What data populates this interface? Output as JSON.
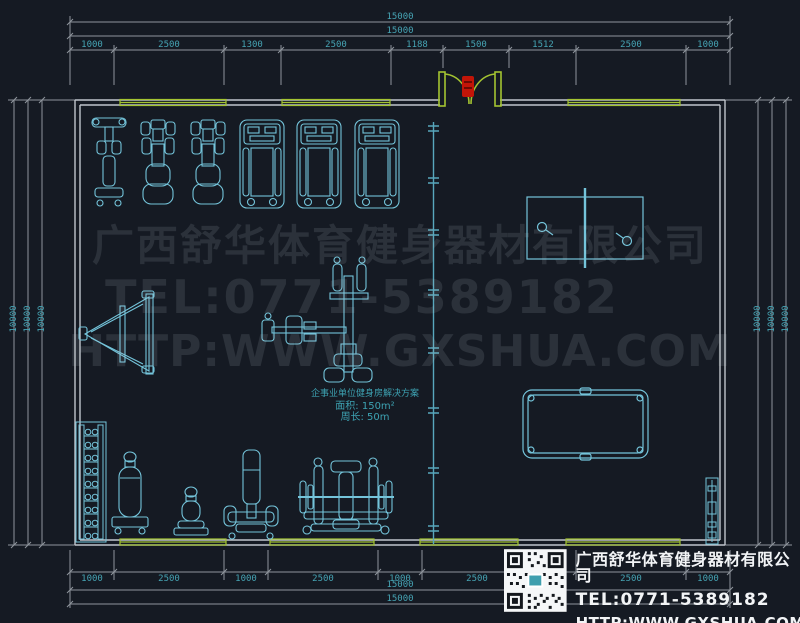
{
  "drawing_type": "gym-floor-plan-cad",
  "dimensions": {
    "top": {
      "overall": [
        "15000",
        "15000"
      ],
      "segments": [
        "1000",
        "2500",
        "1300",
        "2500",
        "1188",
        "1500",
        "1512",
        "2500",
        "1000"
      ]
    },
    "bottom": {
      "segments": [
        "1000",
        "2500",
        "1000",
        "2500",
        "1000",
        "2500",
        "1000",
        "2500",
        "1000"
      ],
      "overall": [
        "15000",
        "15000"
      ]
    },
    "left": [
      "10000",
      "10000",
      "10000"
    ],
    "right": [
      "10000",
      "10000",
      "10000"
    ]
  },
  "room_label": {
    "title": "企事业单位健身房解决方案",
    "area": "面积: 150m²",
    "perimeter": "周长: 50m"
  },
  "watermark": {
    "company": "广西舒华体育健身器材有限公司",
    "tel": "TEL:0771-5389182",
    "url": "HTTP:WWW.GXSHUA.COM"
  },
  "info_panel": {
    "company": "广西舒华体育健身器材有限公司",
    "tel": "TEL:0771-5389182",
    "url": "HTTP:WWW.GXSHUA.COM"
  },
  "equipment": [
    "elliptical-trainer",
    "recumbent-bike",
    "recumbent-bike",
    "treadmill",
    "treadmill",
    "treadmill",
    "sit-up-bench",
    "multi-station-trainer",
    "dumbbell-rack",
    "punching-bag",
    "stepper-stool",
    "vertical-trainer",
    "bench-press",
    "table-tennis-table",
    "billiard-table",
    "cue-rack"
  ],
  "colors": {
    "background": "#151a23",
    "wall": "#c0c5cc",
    "window": "#a4c431",
    "equipment": "#74c4da",
    "partition": "#58a7bd",
    "dimension_line": "#8e949c",
    "dimension_text": "#46a4b4",
    "door_marker": "#c21508",
    "watermark": "rgba(195,205,220,0.13)",
    "info_text": "#f2f4f6"
  }
}
